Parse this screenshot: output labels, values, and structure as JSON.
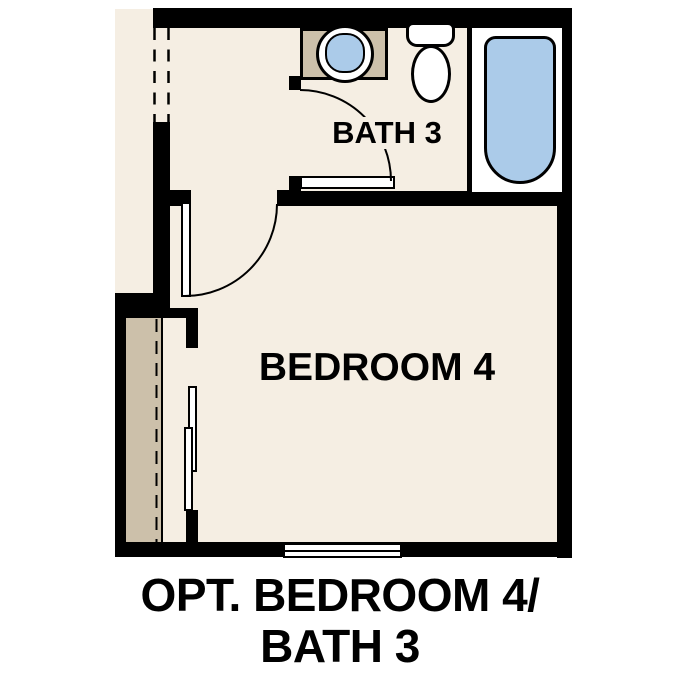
{
  "plan": {
    "rooms": {
      "bath": {
        "label": "BATH 3"
      },
      "bedroom": {
        "label": "BEDROOM 4"
      }
    },
    "caption": {
      "line1": "OPT. BEDROOM 4/",
      "line2": "BATH 3"
    },
    "fixtures": {
      "sink": "sink-icon",
      "toilet": "toilet-icon",
      "bathtub": "bathtub-icon",
      "vanity": "vanity-cabinet",
      "closet": "closet-with-rod",
      "sliding_doors": "bypass-sliding-doors",
      "window": "window-symbol",
      "swing_doors": "door-swing-arc",
      "cased_opening": "dashed-opening"
    },
    "colors": {
      "floor": "#F5EEE3",
      "wall": "#000000",
      "cabinet": "#CCC0AA",
      "water": "#ABCBE9",
      "paper": "#FFFFFF",
      "line": "#000000"
    }
  }
}
